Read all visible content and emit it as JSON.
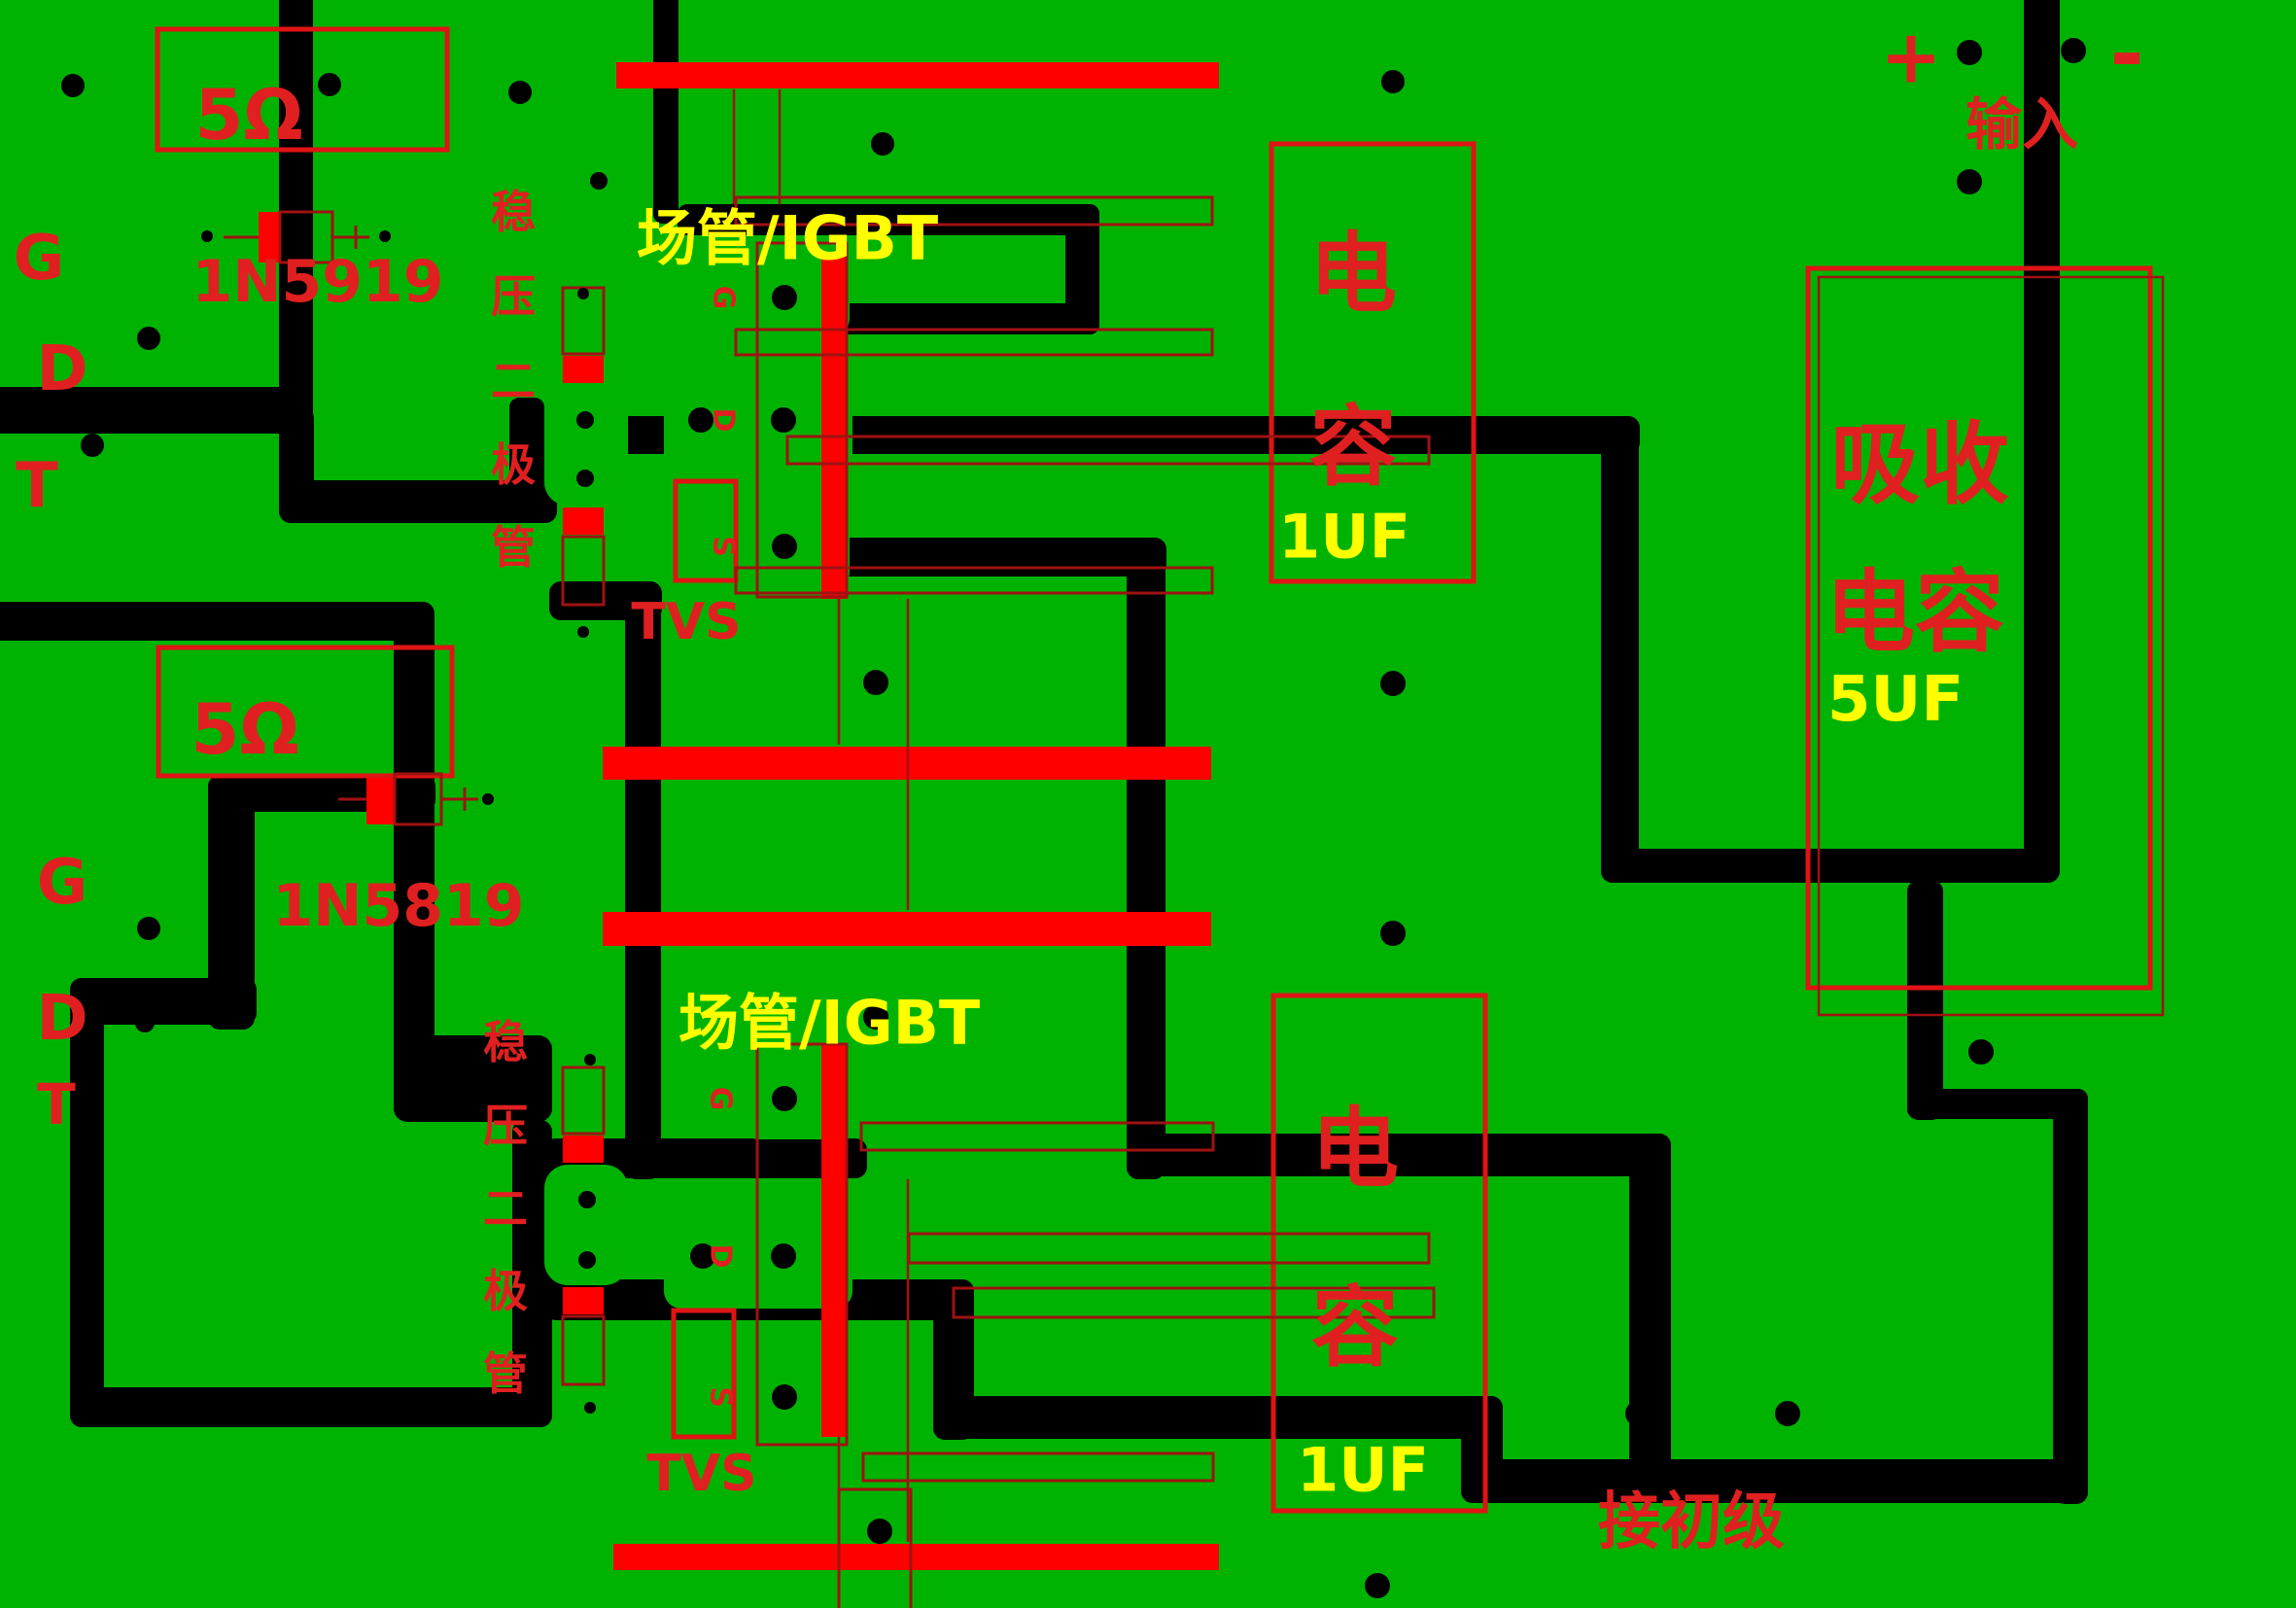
{
  "board": {
    "description": "PCB copper layout with silkscreen annotations, gate-drive circuit",
    "colors": {
      "board-green": "#00B303",
      "copper": "#000000",
      "bright-red": "#FF0000",
      "silk-red": "#E02020",
      "outline-red": "#A01212",
      "box-red": "#E01414",
      "label-yellow": "#FFFF00"
    }
  },
  "sections": {
    "gate_drive_top": {
      "terminals": {
        "g": "G",
        "d": "D",
        "t": "T"
      },
      "resistor_label": "5Ω",
      "diode_label": "1N5919",
      "zener_label": "稳压二极管",
      "transistor_label": "场管/IGBT",
      "transistor_pins": {
        "g": "G",
        "d": "D",
        "s": "S"
      },
      "tvs_label": "TVS",
      "capacitor": {
        "name": "电容",
        "value": "1UF"
      }
    },
    "gate_drive_bottom": {
      "terminals": {
        "g": "G",
        "d": "D",
        "t": "T"
      },
      "resistor_label": "5Ω",
      "diode_label": "1N5819",
      "zener_label": "稳压二极管",
      "transistor_label": "场管/IGBT",
      "transistor_pins": {
        "g": "G",
        "d": "D",
        "s": "S"
      },
      "tvs_label": "TVS",
      "capacitor": {
        "name": "电容",
        "value": "1UF"
      }
    },
    "input": {
      "plus": "+",
      "minus": "-",
      "label": "输入"
    },
    "snubber": {
      "name_line1": "吸收",
      "name_line2": "电容",
      "value": "5UF"
    },
    "primary": {
      "label": "接初级"
    }
  }
}
